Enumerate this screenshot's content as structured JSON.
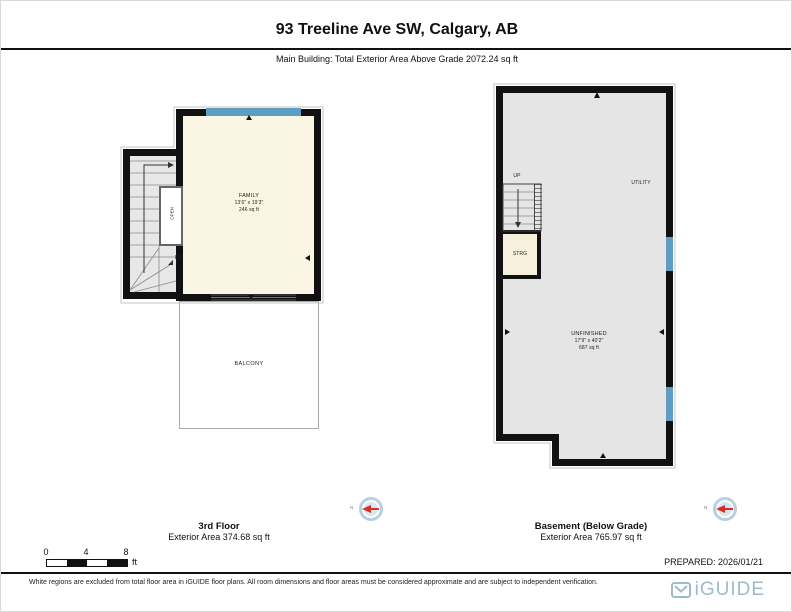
{
  "header": {
    "title": "93 Treeline Ave SW, Calgary, AB",
    "subtitle": "Main Building: Total Exterior Area Above Grade 2072.24 sq ft"
  },
  "plans": {
    "third": {
      "title": "3rd Floor",
      "area": "Exterior Area 374.68 sq ft",
      "family": {
        "name": "FAMILY",
        "dims": "13'6\" x 19'3\"",
        "area": "246 sq ft"
      },
      "balcony": "BALCONY",
      "open": "OPEN",
      "dn": "DN"
    },
    "basement": {
      "title": "Basement (Below Grade)",
      "area": "Exterior Area 765.97 sq ft",
      "unfinished": {
        "name": "UNFINISHED",
        "dims": "17'9\" x 40'2\"",
        "area": "687 sq ft"
      },
      "utility": "UTILITY",
      "strg": "STRG",
      "up": "UP"
    }
  },
  "compass": {
    "north": "N"
  },
  "scale_bar": {
    "t0": "0",
    "t4": "4",
    "t8": "8",
    "unit": "ft"
  },
  "footer": {
    "prepared": "PREPARED: 2026/01/21",
    "disclaimer": "White regions are excluded from total floor area in iGUIDE floor plans. All room dimensions and floor areas must be considered approximate and are subject to independent verification.",
    "brand": "iGUIDE"
  },
  "colors": {
    "wall": "#111111",
    "window_blue": "#5E9EC2",
    "room_cream": "#FBF6E3",
    "room_gray": "#E5E5E5",
    "storage_cream": "#F7F0DC",
    "brand_blue": "#9FBACB",
    "compass_red": "#D93025"
  }
}
